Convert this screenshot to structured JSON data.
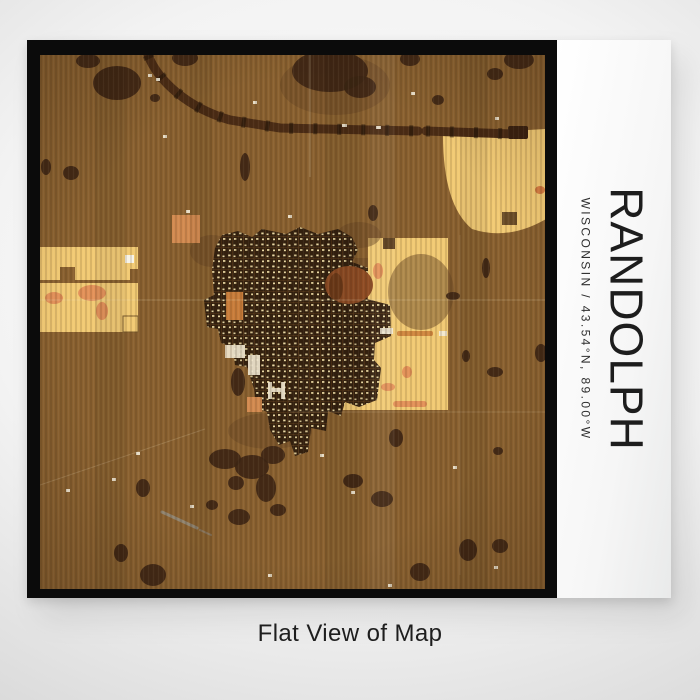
{
  "page": {
    "caption": "Flat View of Map"
  },
  "poster": {
    "title": "RANDOLPH",
    "subtitle": "WISCONSIN / 43.54°N, 89.00°W"
  },
  "colors": {
    "frame": "#0b0b0b",
    "poster-bg": "#fbfbfb",
    "text": "#1d1d1d",
    "map-base": "#8a6130",
    "map-dark": "#3e2615",
    "map-town": "#33200f",
    "map-field": "#f2ca74",
    "map-orange": "#d28a50"
  }
}
